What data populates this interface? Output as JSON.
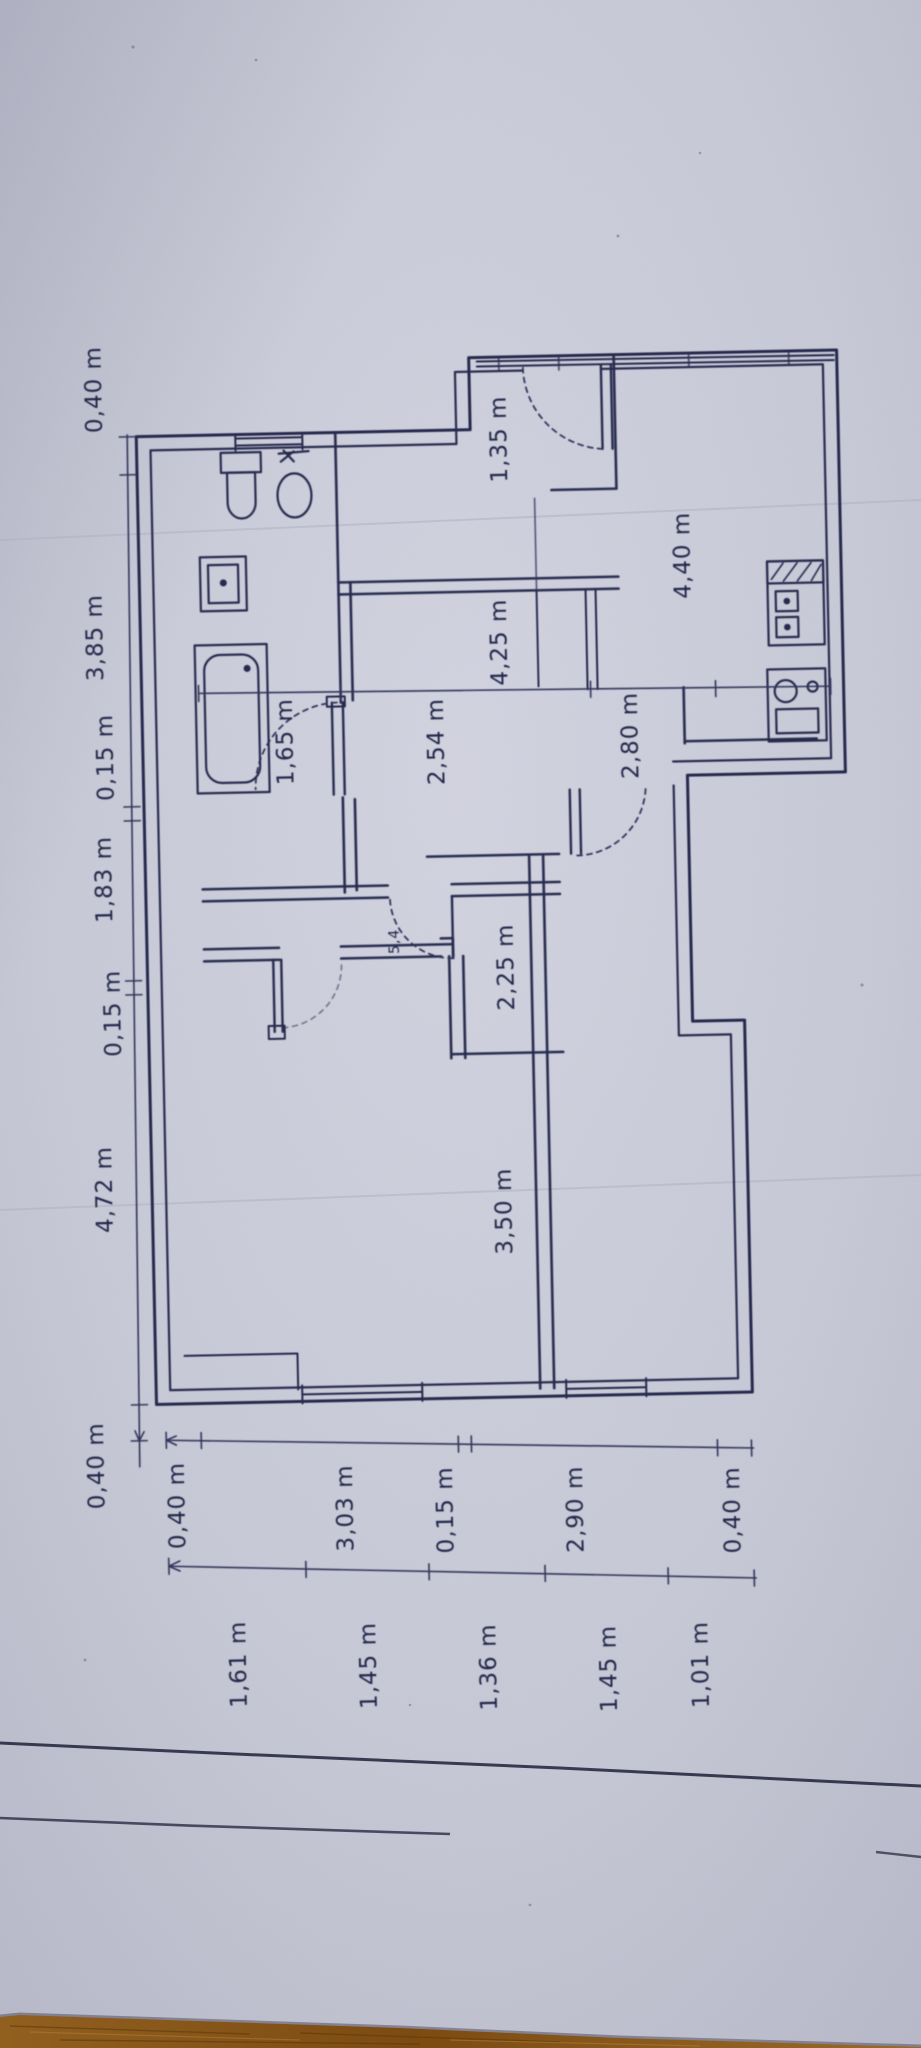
{
  "photo": {
    "subject": "hand-drawn apartment floor plan on paper, photographed at a slight angle with wooden floor visible at the bottom edge"
  },
  "colors": {
    "paper": "#cbccd9",
    "paper_edge": "#b4b5c6",
    "ink": "#262a4e",
    "wood": "#8a5a1e",
    "wood_dark": "#5e3a0c"
  },
  "dimensions": {
    "left_chain": [
      {
        "text": "0,40 m"
      },
      {
        "text": "3,85 m"
      },
      {
        "text": "0,15 m"
      },
      {
        "text": "1,83 m"
      },
      {
        "text": "0,15 m"
      },
      {
        "text": "4,72 m"
      },
      {
        "text": "0,40 m"
      }
    ],
    "bottom_outer": [
      {
        "text": "0,40 m"
      },
      {
        "text": "3,03 m"
      },
      {
        "text": "0,15 m"
      },
      {
        "text": "2,90 m"
      },
      {
        "text": "0,40 m"
      }
    ],
    "bottom_inner": [
      {
        "text": "1,61 m"
      },
      {
        "text": "1,45 m"
      },
      {
        "text": "1,36 m"
      },
      {
        "text": "1,45 m"
      },
      {
        "text": "1,01 m"
      }
    ]
  },
  "interior_labels": [
    {
      "text": "1,35 m"
    },
    {
      "text": "4,40 m"
    },
    {
      "text": "4,25 m"
    },
    {
      "text": "2,54 m"
    },
    {
      "text": "1,65 m"
    },
    {
      "text": "2,80 m"
    },
    {
      "text": "2,25 m"
    },
    {
      "text": "3,50 m"
    },
    {
      "text": "5,4"
    }
  ]
}
